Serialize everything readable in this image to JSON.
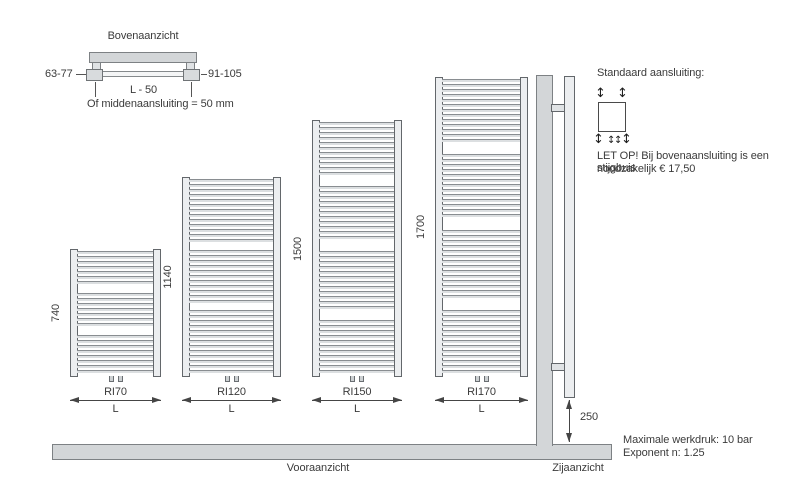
{
  "top_view": {
    "title": "Bovenaanzicht",
    "left_dim": "63-77",
    "right_dim": "91-105",
    "length_dim": "L - 50",
    "note": "Of middenaansluiting = 50 mm"
  },
  "radiators": [
    {
      "name": "RI70",
      "height": "740",
      "width_label": "L",
      "tube_groups": [
        7,
        7,
        8
      ]
    },
    {
      "name": "RI120",
      "height": "1140",
      "width_label": "L",
      "tube_groups": [
        13,
        11,
        13
      ]
    },
    {
      "name": "RI150",
      "height": "1500",
      "width_label": "L",
      "tube_groups": [
        11,
        11,
        12,
        11
      ]
    },
    {
      "name": "RI170",
      "height": "1700",
      "width_label": "L",
      "tube_groups": [
        13,
        13,
        14,
        13
      ]
    }
  ],
  "views": {
    "front": "Vooraanzicht",
    "side": "Zijaanzicht"
  },
  "side_view": {
    "floor_clearance": "250"
  },
  "connection": {
    "title": "Standaard aansluiting:",
    "warning_line1": "LET OP! Bij bovenaansluiting is een stijgbuis",
    "warning_line2": "noodzakelijk € 17,50"
  },
  "specs": {
    "max_pressure": "Maximale werkdruk: 10 bar",
    "exponent": "Exponent n: 1.25"
  },
  "icons": {
    "v_arrow": "↕"
  },
  "colors": {
    "fill_gray": "#d3d6d8",
    "rail_fill": "#eceef0",
    "line": "#454545",
    "text": "#3b3b3b"
  }
}
